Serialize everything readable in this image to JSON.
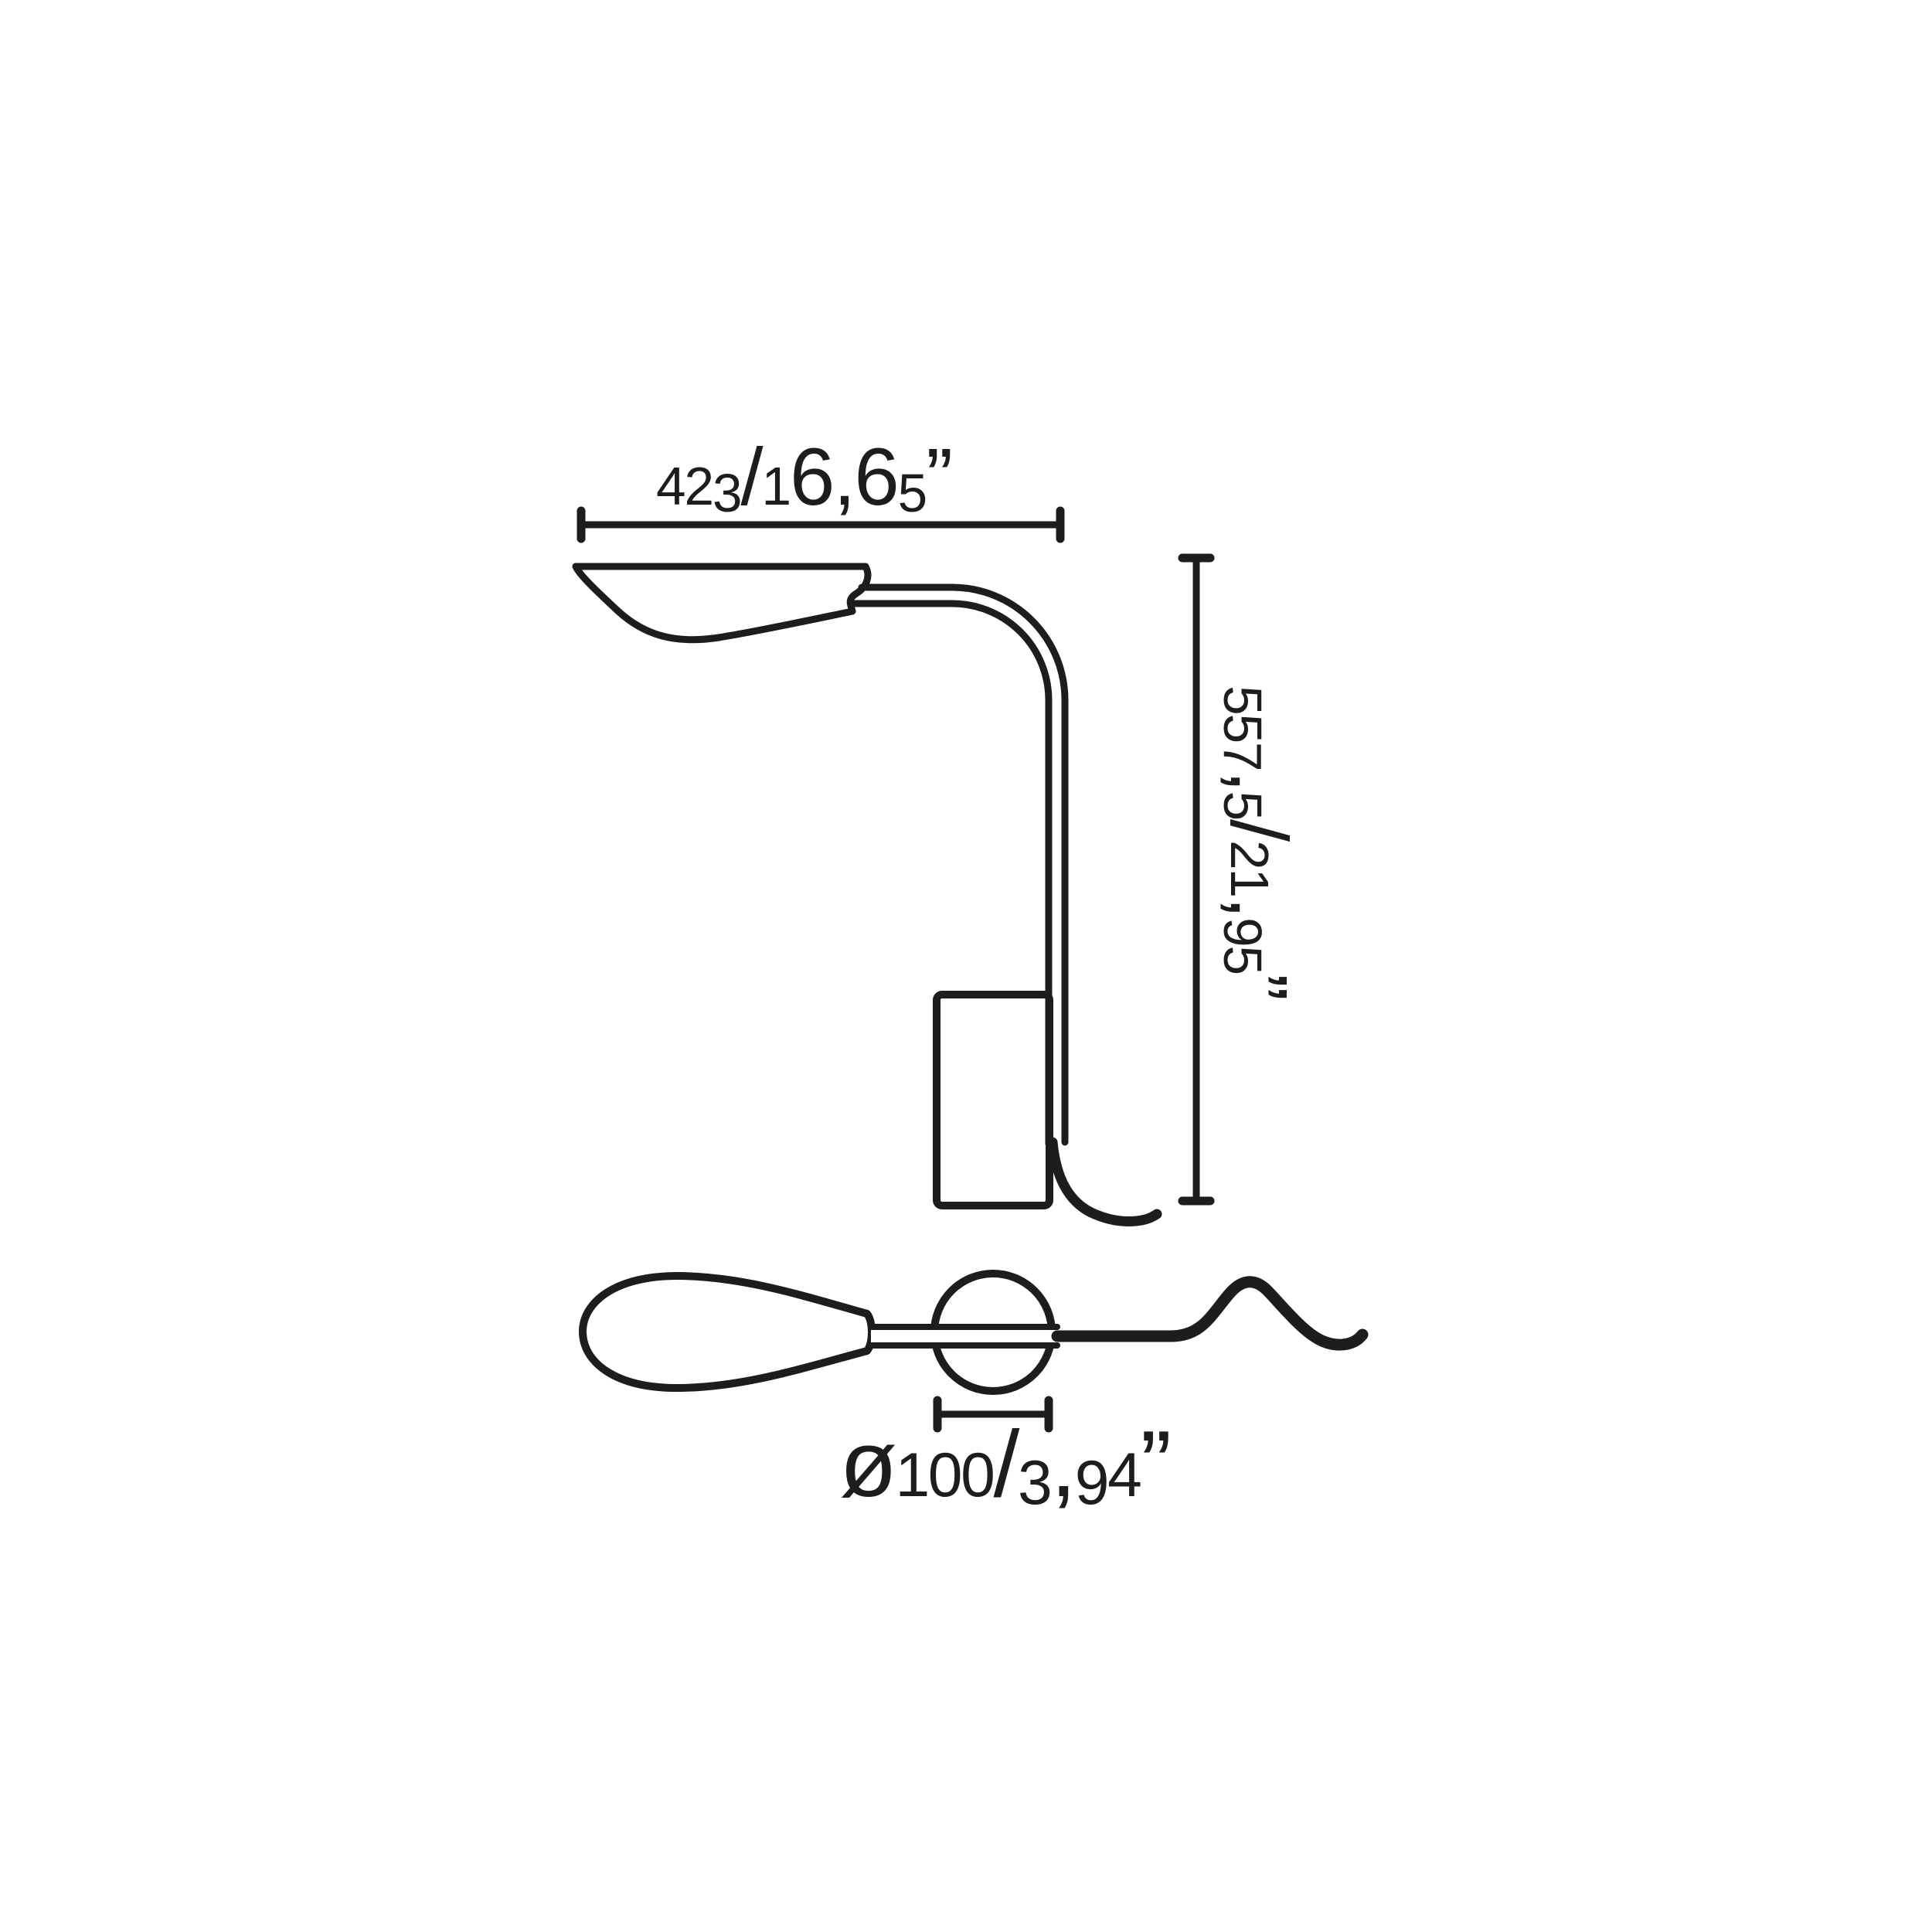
{
  "colors": {
    "line": "#1d1d1b",
    "background": "#ffffff"
  },
  "diagram": {
    "dimensions": {
      "width": {
        "label": "423/16,65”",
        "mm": "423",
        "inches": "16,65”"
      },
      "height": {
        "label": "557,5/21,95”",
        "mm": "557,5",
        "inches": "21,95”"
      },
      "diameter": {
        "label": "ø100/3,94”",
        "mm": "ø100",
        "inches": "3,94”"
      }
    }
  }
}
